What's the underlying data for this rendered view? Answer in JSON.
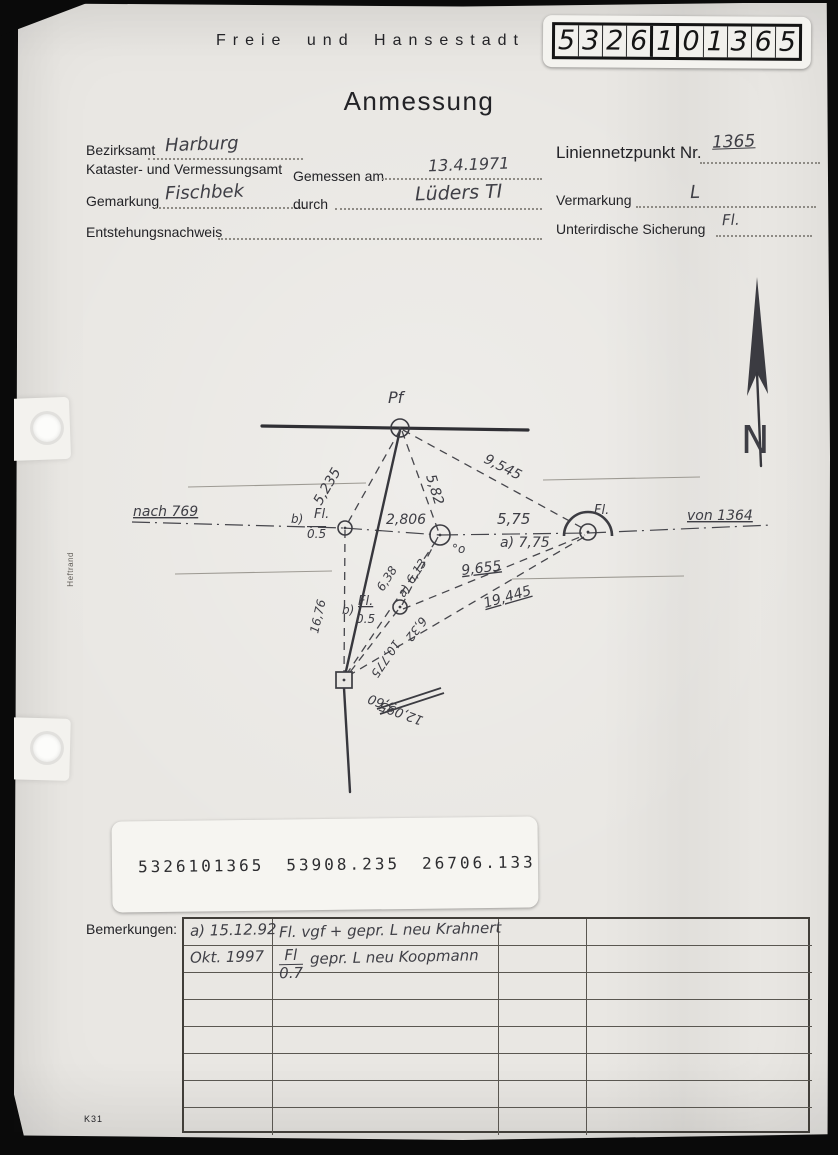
{
  "header": {
    "agency_line": "Freie und Hansestadt H",
    "title": "Anmessung",
    "sticker_digits": [
      "5",
      "3",
      "2",
      "6",
      "1",
      "0",
      "1",
      "3",
      "6",
      "5"
    ]
  },
  "form": {
    "bezirksamt": {
      "label": "Bezirksamt",
      "value": "Harburg"
    },
    "amt_line": "Kataster- und Vermessungsamt",
    "gemessen_am": {
      "label": "Gemessen am",
      "value": "13.4.1971"
    },
    "gemarkung": {
      "label": "Gemarkung",
      "value": "Fischbek"
    },
    "durch": {
      "label": "durch",
      "value": "Lüders TI"
    },
    "entstehungsnachweis": {
      "label": "Entstehungsnachweis",
      "value": ""
    },
    "liniennetzpunkt": {
      "label": "Liniennetzpunkt Nr.",
      "value": "1365"
    },
    "vermarkung": {
      "label": "Vermarkung",
      "value": "L"
    },
    "unterirdische_sicherung": {
      "label": "Unterirdische Sicherung",
      "value": "Fl."
    }
  },
  "coordinate_sticker": {
    "point_id": "5326101365",
    "coord_x": "53908.235",
    "coord_y": "26706.133"
  },
  "bemerkungen": {
    "label": "Bemerkungen:",
    "rows": [
      {
        "date": "a) 15.12.92",
        "text": "Fl. vgf + gepr. L neu Krahnert"
      },
      {
        "date": "Okt. 1997",
        "fraction": {
          "top": "Fl",
          "bottom": "0.7"
        },
        "text": "gepr. L neu Koopmann"
      },
      {},
      {},
      {},
      {},
      {},
      {}
    ]
  },
  "margin_notes": {
    "heftrand": "Heftrand",
    "form_code": "K31"
  },
  "sketch": {
    "thick_lines": [
      [
        262,
        426,
        528,
        430
      ]
    ],
    "main_lines": [
      [
        400,
        430,
        344,
        680
      ],
      [
        344,
        688,
        350,
        792
      ]
    ],
    "faint_lines": [
      [
        188,
        487,
        366,
        483
      ],
      [
        543,
        480,
        700,
        477
      ],
      [
        175,
        574,
        332,
        571
      ],
      [
        512,
        579,
        684,
        576
      ]
    ],
    "dashdot_lines": [
      [
        132,
        522,
        344,
        528
      ],
      [
        344,
        528,
        440,
        535
      ],
      [
        440,
        535,
        588,
        533
      ],
      [
        588,
        533,
        772,
        525
      ]
    ],
    "dashed_lines": [
      [
        400,
        430,
        346,
        526
      ],
      [
        402,
        431,
        439,
        533
      ],
      [
        403,
        430,
        586,
        530
      ],
      [
        438,
        537,
        402,
        605
      ],
      [
        403,
        609,
        585,
        535
      ],
      [
        348,
        676,
        584,
        537
      ],
      [
        345,
        530,
        344,
        678
      ],
      [
        398,
        610,
        347,
        676
      ],
      [
        346,
        675,
        438,
        538
      ]
    ],
    "tick_lines": [
      [
        377,
        709,
        441,
        688
      ],
      [
        380,
        714,
        444,
        693
      ]
    ],
    "points": [
      {
        "type": "circle",
        "x": 400,
        "y": 428,
        "r": 9
      },
      {
        "type": "circle",
        "x": 345,
        "y": 528,
        "r": 7
      },
      {
        "type": "circle",
        "x": 440,
        "y": 535,
        "r": 10
      },
      {
        "type": "circle",
        "x": 588,
        "y": 532,
        "r": 8,
        "arc": true
      },
      {
        "type": "circle",
        "x": 400,
        "y": 607,
        "r": 7
      },
      {
        "type": "square",
        "x": 344,
        "y": 680,
        "s": 16
      }
    ],
    "labels": [
      {
        "t": "Pf",
        "x": 388,
        "y": 403,
        "s": 16
      },
      {
        "t": "nach 769",
        "x": 133,
        "y": 516,
        "s": 14,
        "u": true
      },
      {
        "t": "von 1364",
        "x": 687,
        "y": 520,
        "s": 14,
        "u": true
      },
      {
        "t": "b)",
        "x": 291,
        "y": 523,
        "s": 12
      },
      {
        "t": "Fl.",
        "x": 314,
        "y": 518,
        "s": 13
      },
      {
        "t": "0.5",
        "x": 307,
        "y": 538,
        "s": 12,
        "o": true
      },
      {
        "t": "2,806",
        "x": 386,
        "y": 524,
        "s": 14
      },
      {
        "t": "5,75",
        "x": 497,
        "y": 524,
        "s": 15
      },
      {
        "t": "a) 7,75",
        "x": 500,
        "y": 547,
        "s": 14
      },
      {
        "t": "°o",
        "x": 452,
        "y": 553,
        "s": 12
      },
      {
        "t": "Fl.",
        "x": 594,
        "y": 514,
        "s": 13
      },
      {
        "t": "5,235",
        "x": 321,
        "y": 506,
        "s": 14,
        "r": -60
      },
      {
        "t": "5,82",
        "x": 426,
        "y": 476,
        "s": 14,
        "r": 73
      },
      {
        "t": "9,545",
        "x": 483,
        "y": 462,
        "s": 14,
        "r": 27
      },
      {
        "t": "6,38",
        "x": 383,
        "y": 592,
        "s": 12,
        "r": -57
      },
      {
        "t": "a) 6,13",
        "x": 404,
        "y": 598,
        "s": 12,
        "r": -57
      },
      {
        "t": "9,655",
        "x": 462,
        "y": 575,
        "s": 14,
        "r": -7,
        "u": true
      },
      {
        "t": "19,445",
        "x": 485,
        "y": 608,
        "s": 14,
        "r": -16,
        "u": true
      },
      {
        "t": "16,76",
        "x": 318,
        "y": 634,
        "s": 12,
        "r": -77
      },
      {
        "t": "b)",
        "x": 342,
        "y": 614,
        "s": 12
      },
      {
        "t": "Fl.",
        "x": 358,
        "y": 605,
        "s": 13,
        "u": true
      },
      {
        "t": "0.5",
        "x": 356,
        "y": 623,
        "s": 12
      },
      {
        "t": "6,32",
        "x": 421,
        "y": 616,
        "s": 12,
        "r": 127
      },
      {
        "t": "10,775",
        "x": 394,
        "y": 639,
        "s": 12,
        "r": 124
      },
      {
        "t": "5,60",
        "x": 397,
        "y": 704,
        "s": 13,
        "r": 200
      },
      {
        "t": "12,095",
        "x": 424,
        "y": 717,
        "s": 13,
        "r": 200
      }
    ],
    "north_arrow": {
      "head": [
        [
          757,
          277
        ],
        [
          747,
          396
        ],
        [
          757,
          373
        ],
        [
          768,
          394
        ]
      ],
      "shaft": [
        757,
        373,
        761,
        466
      ],
      "letter": "N"
    }
  }
}
